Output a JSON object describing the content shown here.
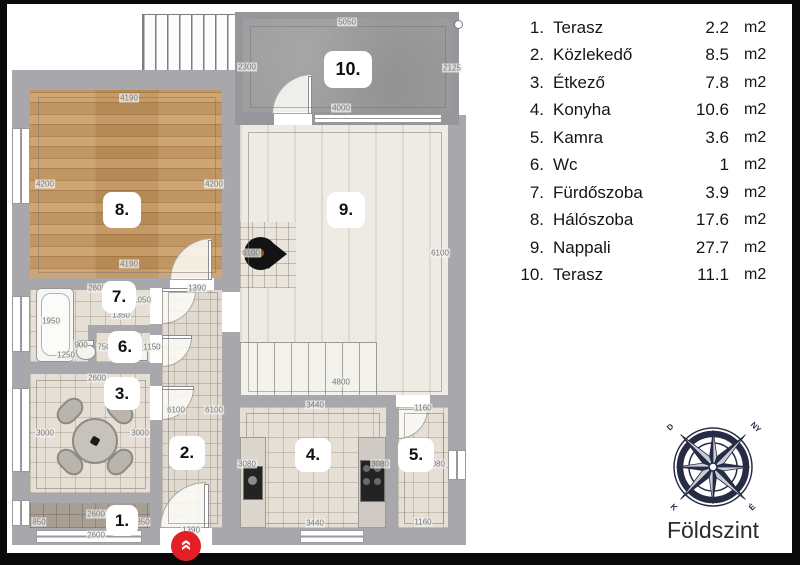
{
  "legend": {
    "items": [
      {
        "num": "1.",
        "name": "Terasz",
        "area": "2.2",
        "unit": "m2"
      },
      {
        "num": "2.",
        "name": "Közlekedő",
        "area": "8.5",
        "unit": "m2"
      },
      {
        "num": "3.",
        "name": "Étkező",
        "area": "7.8",
        "unit": "m2"
      },
      {
        "num": "4.",
        "name": "Konyha",
        "area": "10.6",
        "unit": "m2"
      },
      {
        "num": "5.",
        "name": "Kamra",
        "area": "3.6",
        "unit": "m2"
      },
      {
        "num": "6.",
        "name": "Wc",
        "area": "1",
        "unit": "m2"
      },
      {
        "num": "7.",
        "name": "Fürdőszoba",
        "area": "3.9",
        "unit": "m2"
      },
      {
        "num": "8.",
        "name": "Hálószoba",
        "area": "17.6",
        "unit": "m2"
      },
      {
        "num": "9.",
        "name": "Nappali",
        "area": "27.7",
        "unit": "m2"
      },
      {
        "num": "10.",
        "name": "Terasz",
        "area": "11.1",
        "unit": "m2"
      }
    ]
  },
  "plan": {
    "floor_label": "Földszint",
    "room_badges": [
      "1.",
      "2.",
      "3.",
      "4.",
      "5.",
      "6.",
      "7.",
      "8.",
      "9.",
      "10."
    ],
    "dims": [
      "5050",
      "2300",
      "2125",
      "4000",
      "4190",
      "4200",
      "4200",
      "4190",
      "6100",
      "6100",
      "4800",
      "2600",
      "1390",
      "1050",
      "1350",
      "1950",
      "900",
      "750",
      "1150",
      "1250",
      "2600",
      "6100",
      "6100",
      "3000",
      "3000",
      "3440",
      "1160",
      "3080",
      "3080",
      "3080",
      "2600",
      "850",
      "850",
      "2600",
      "1390",
      "3440",
      "1160"
    ],
    "compass": {
      "nw": "D",
      "ne": "NY",
      "sw": "K",
      "se": "É"
    },
    "entrance_chevron": "»",
    "colors": {
      "wall": "#a8a8ac",
      "wood": "#c2975f",
      "terrace_concrete": "#9c9c9e",
      "accent_red": "#e31e24",
      "compass_navy": "#272c45"
    }
  }
}
